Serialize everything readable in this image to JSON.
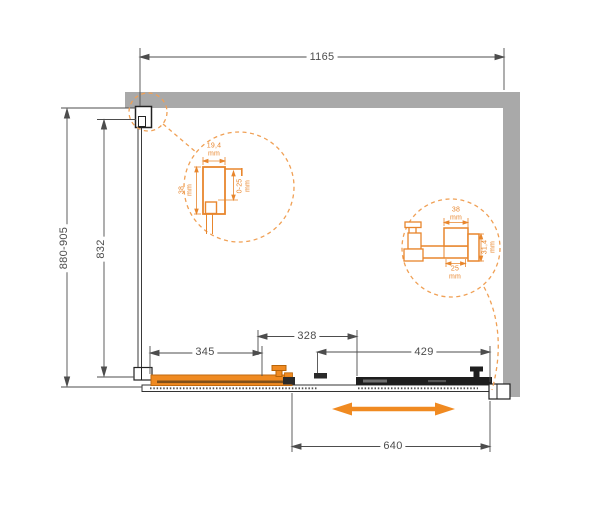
{
  "dimensions": {
    "total_width": "1165",
    "depth_range": "880-905",
    "side_glass_depth": "832",
    "sliding_door_width": "345",
    "overlap_width": "328",
    "fixed_panel_width": "429",
    "opening_width": "640"
  },
  "detail_left": {
    "profile_width": {
      "value": "19,4",
      "unit": "mm"
    },
    "profile_depth": {
      "value": "38",
      "unit": "mm"
    },
    "adjustment_range": {
      "value": "0-25",
      "unit": "mm"
    }
  },
  "detail_right": {
    "profile_top_width": {
      "value": "38",
      "unit": "mm"
    },
    "profile_height": {
      "value": "31,4",
      "unit": "mm"
    },
    "profile_bottom_width": {
      "value": "25",
      "unit": "mm"
    }
  },
  "icons": {
    "slide_direction_arrow": "double-headed-horizontal-arrow",
    "detail_callout_circle": "dashed-magnifier-circle"
  },
  "colors": {
    "accent_orange": "#F08A21",
    "detail_orange": "#E8862D",
    "dashed_orange": "#F0A055",
    "wall_gray": "#A9A9A9",
    "panel_black": "#1E1E1E",
    "dim_gray": "#4D4D4D"
  }
}
